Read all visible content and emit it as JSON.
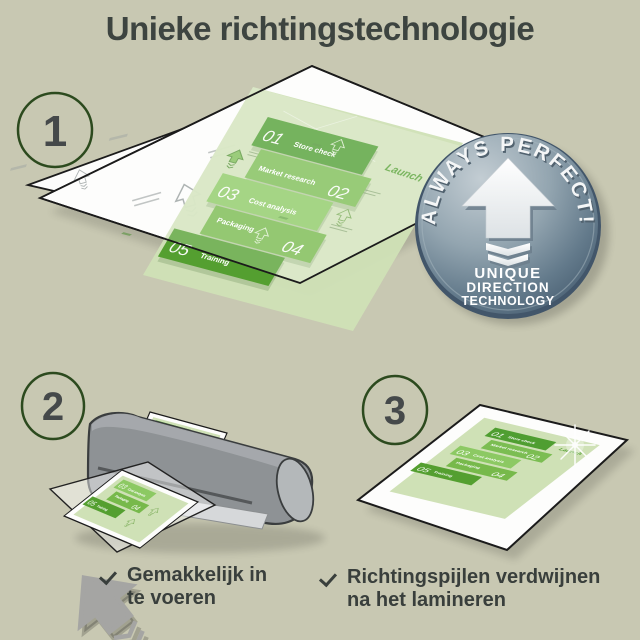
{
  "title": "Unieke richtingstechnologie",
  "steps": {
    "one": "1",
    "two": "2",
    "three": "3"
  },
  "badge": {
    "arc_text": "ALWAYS PERFECT!",
    "line1": "UNIQUE",
    "line2": "DIRECTION",
    "line3": "TECHNOLOGY"
  },
  "doc": {
    "n1": "01",
    "l1": "Store check",
    "l2": "Market research",
    "n2": "02",
    "n3": "03",
    "l3": "Cost analysis",
    "l4": "Packaging",
    "n4": "04",
    "n5": "05",
    "l5": "Training",
    "launch": "Launch"
  },
  "captions": {
    "c1l1": "Gemakkelijk in",
    "c1l2": "te voeren",
    "c2l1": "Richtingspijlen verdwijnen",
    "c2l2": "na het lamineren"
  },
  "colors": {
    "background": "#c8c8b2",
    "title_text": "#3d4440",
    "circle_green": "#2c4a1e",
    "doc_background": "#cfe1b6",
    "green_dark": "#4f9e31",
    "green_mid": "#77b94b",
    "green_light": "#8cc963",
    "launch_green": "#55a033",
    "badge_slate": "#5d7384",
    "laminator_gray": "#8e9295",
    "feed_arrow_gray": "#a5a5a3",
    "outline_black": "#1b1b1b"
  }
}
